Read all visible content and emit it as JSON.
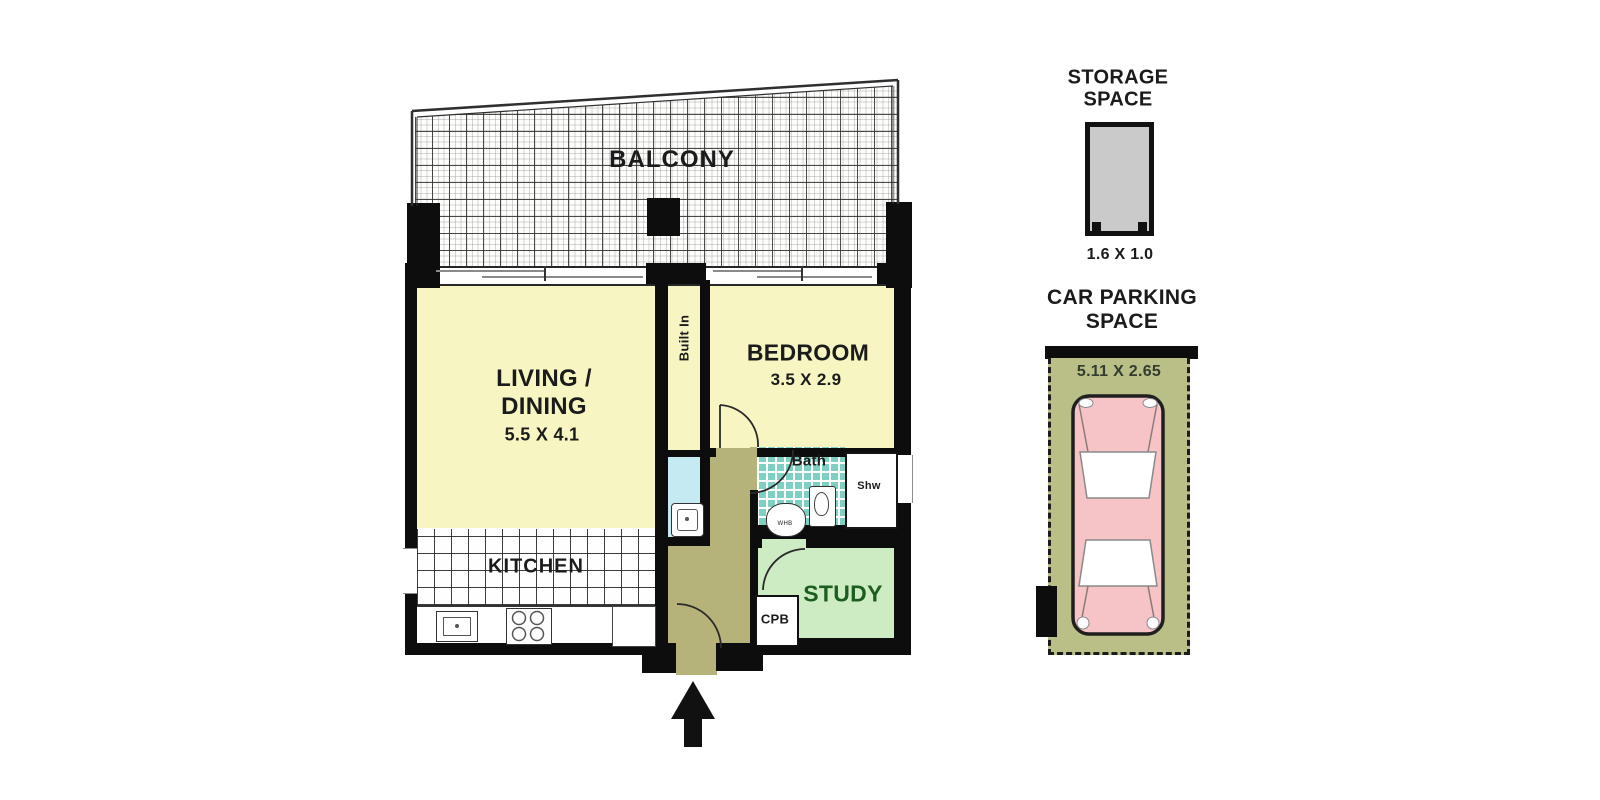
{
  "plan": {
    "balcony_label": "BALCONY",
    "living": {
      "line1": "LIVING /",
      "line2": "DINING",
      "dims": "5.5 X 4.1"
    },
    "bedroom": {
      "name": "BEDROOM",
      "dims": "3.5 X 2.9"
    },
    "built_in_label": "Built In",
    "bath": {
      "name": "Bath",
      "shower": "Shw",
      "basin": "WHB"
    },
    "kitchen_label": "KITCHEN",
    "study_label": "STUDY",
    "cupboard_label": "CPB"
  },
  "storage": {
    "title1": "STORAGE",
    "title2": "SPACE",
    "dims": "1.6 X 1.0"
  },
  "parking": {
    "title1": "CAR PARKING",
    "title2": "SPACE",
    "dims": "5.11 X 2.65"
  },
  "colors": {
    "wall": "#0d0d0d",
    "room_yellow": "#f7f5c2",
    "hallway_olive": "#b5b37a",
    "laundry_blue": "#c6eaf2",
    "bath_teal": "#7ed0c3",
    "study_green": "#cdecc4",
    "parking_olive": "#babf87",
    "car_pink": "#f6c4c6",
    "storage_grey": "#cacaca",
    "study_text_green": "#1d5e20"
  }
}
